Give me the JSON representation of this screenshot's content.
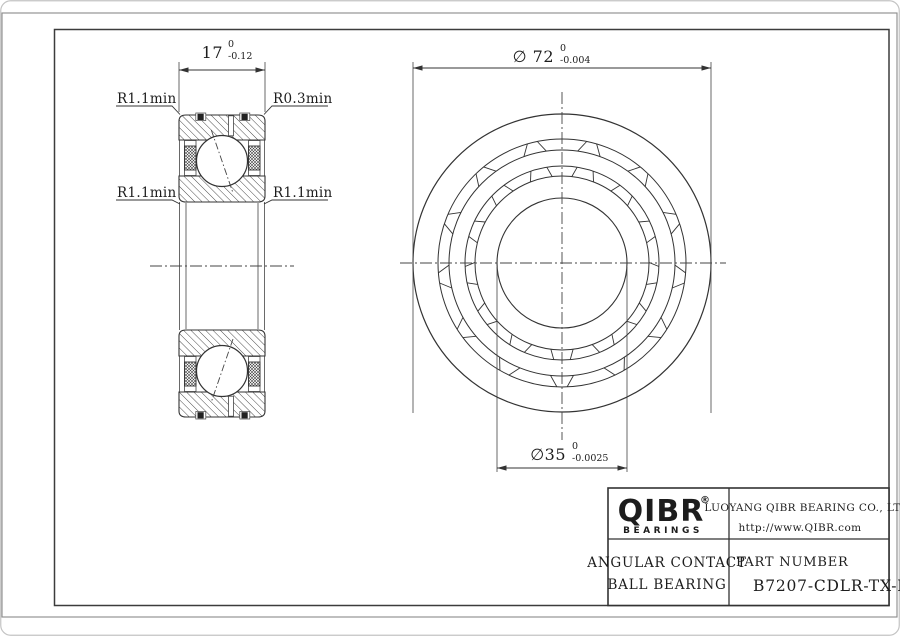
{
  "section_view": {
    "dim_width": {
      "value": "17",
      "tol_upper": "0",
      "tol_lower": "-0.12"
    },
    "label_top_left": "R1.1min",
    "label_top_right": "R0.3min",
    "label_mid_left": "R1.1min",
    "label_mid_right": "R1.1min"
  },
  "front_view": {
    "dim_outer": {
      "value": "∅ 72",
      "tol_upper": "0",
      "tol_lower": "-0.004"
    },
    "dim_bore": {
      "value": "∅35",
      "tol_upper": "0",
      "tol_lower": "-0.0025"
    }
  },
  "title_block": {
    "logo": {
      "name": "QIBR",
      "registered": "®",
      "tagline": "BEARINGS"
    },
    "company": {
      "name": "LUOYANG QIBR BEARING CO., LTD",
      "website": "http://www.QIBR.com"
    },
    "product": {
      "line1": "ANGULAR CONTACT",
      "line2": "BALL BEARING"
    },
    "part": {
      "label": "PART NUMBER",
      "number": "B7207-CDLR-TX-P2"
    }
  }
}
